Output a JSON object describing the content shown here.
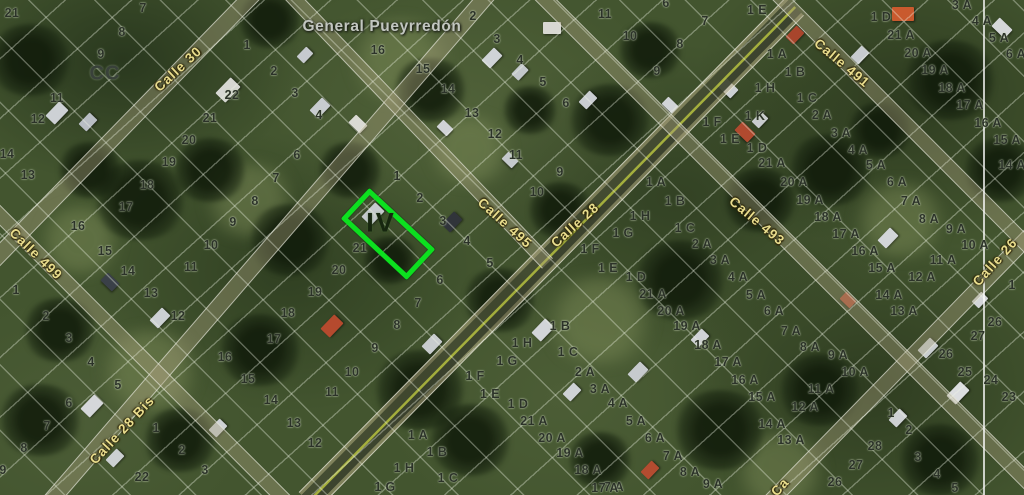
{
  "map": {
    "avenue_label": "General Pueyrredón",
    "avenue_pos": {
      "x": 382,
      "y": 27
    },
    "block_label": "CC",
    "block_label_pos": {
      "x": 105,
      "y": 74
    },
    "highlight": {
      "label": "IV",
      "x": 383,
      "y": 229,
      "w": 80,
      "h": 32,
      "rot": 43,
      "color": "#0ce01f"
    },
    "boundary_x": 983,
    "colors": {
      "parcel_text": "#2c3329",
      "street_text": "#e9dd8d",
      "avenue_text": "#c2c6c0",
      "highlight_stroke": "#0ce01f"
    },
    "streets": [
      {
        "t": "Calle 30",
        "x": 178,
        "y": 69,
        "r": -43
      },
      {
        "t": "Calle 499",
        "x": 36,
        "y": 254,
        "r": 44
      },
      {
        "t": "Calle 28 Bis",
        "x": 122,
        "y": 430,
        "r": -47
      },
      {
        "t": "Calle 495",
        "x": 505,
        "y": 223,
        "r": 42
      },
      {
        "t": "Calle 28",
        "x": 575,
        "y": 225,
        "r": -42
      },
      {
        "t": "Calle 493",
        "x": 757,
        "y": 221,
        "r": 40
      },
      {
        "t": "Calle 491",
        "x": 842,
        "y": 63,
        "r": 40
      },
      {
        "t": "Calle 26",
        "x": 995,
        "y": 262,
        "r": -48
      },
      {
        "t": "Ca",
        "x": 780,
        "y": 487,
        "r": -48
      }
    ],
    "roads": [
      {
        "name": "calle-30",
        "x1": 258,
        "y1": -12,
        "x2": -12,
        "y2": 265,
        "w": 15,
        "kind": "minor"
      },
      {
        "name": "calle-28-bis",
        "x1": 492,
        "y1": -12,
        "x2": 50,
        "y2": 500,
        "w": 15,
        "kind": "minor"
      },
      {
        "name": "calle-28",
        "x1": 795,
        "y1": 5,
        "x2": 308,
        "y2": 500,
        "w": 24,
        "kind": "major"
      },
      {
        "name": "calle-26",
        "x1": 1035,
        "y1": 228,
        "x2": 765,
        "y2": 505,
        "w": 14,
        "kind": "minor"
      },
      {
        "name": "calle-499",
        "x1": -12,
        "y1": 202,
        "x2": 288,
        "y2": 502,
        "w": 13,
        "kind": "minor"
      },
      {
        "name": "calle-495",
        "x1": 286,
        "y1": -12,
        "x2": 548,
        "y2": 262,
        "w": 13,
        "kind": "minor"
      },
      {
        "name": "calle-493",
        "x1": 540,
        "y1": -8,
        "x2": 1035,
        "y2": 487,
        "w": 14,
        "kind": "minor"
      },
      {
        "name": "calle-491",
        "x1": 776,
        "y1": -8,
        "x2": 1030,
        "y2": 247,
        "w": 13,
        "kind": "minor"
      }
    ],
    "parcels": [
      [
        "21",
        12,
        13
      ],
      [
        "7",
        143,
        8
      ],
      [
        "8",
        122,
        32
      ],
      [
        "9",
        101,
        54
      ],
      [
        "11",
        57,
        98
      ],
      [
        "12",
        38,
        119
      ],
      [
        "14",
        7,
        154
      ],
      [
        "13",
        28,
        175
      ],
      [
        "1",
        247,
        45
      ],
      [
        "2",
        274,
        71
      ],
      [
        "3",
        295,
        93
      ],
      [
        "4",
        319,
        115
      ],
      [
        "22",
        232,
        95
      ],
      [
        "21",
        210,
        118
      ],
      [
        "20",
        189,
        140
      ],
      [
        "19",
        169,
        162
      ],
      [
        "18",
        147,
        185
      ],
      [
        "17",
        126,
        207
      ],
      [
        "16",
        78,
        226
      ],
      [
        "15",
        105,
        251
      ],
      [
        "14",
        128,
        271
      ],
      [
        "13",
        151,
        293
      ],
      [
        "12",
        178,
        316
      ],
      [
        "6",
        297,
        155
      ],
      [
        "7",
        276,
        178
      ],
      [
        "8",
        255,
        201
      ],
      [
        "9",
        233,
        222
      ],
      [
        "10",
        211,
        245
      ],
      [
        "11",
        191,
        267
      ],
      [
        "1",
        16,
        290
      ],
      [
        "2",
        46,
        316
      ],
      [
        "3",
        69,
        338
      ],
      [
        "4",
        91,
        362
      ],
      [
        "5",
        118,
        385
      ],
      [
        "6",
        69,
        403
      ],
      [
        "7",
        47,
        426
      ],
      [
        "8",
        24,
        448
      ],
      [
        "9",
        3,
        470
      ],
      [
        "1",
        156,
        428
      ],
      [
        "2",
        182,
        450
      ],
      [
        "3",
        205,
        470
      ],
      [
        "22",
        142,
        477
      ],
      [
        "17",
        274,
        339
      ],
      [
        "16",
        225,
        357
      ],
      [
        "15",
        248,
        379
      ],
      [
        "14",
        271,
        400
      ],
      [
        "13",
        294,
        423
      ],
      [
        "12",
        315,
        443
      ],
      [
        "11",
        332,
        392
      ],
      [
        "10",
        352,
        372
      ],
      [
        "9",
        375,
        348
      ],
      [
        "18",
        288,
        313
      ],
      [
        "1",
        397,
        176
      ],
      [
        "2",
        420,
        198
      ],
      [
        "3",
        443,
        221
      ],
      [
        "4",
        467,
        241
      ],
      [
        "5",
        490,
        263
      ],
      [
        "6",
        440,
        280
      ],
      [
        "7",
        418,
        303
      ],
      [
        "8",
        397,
        325
      ],
      [
        "21",
        360,
        248
      ],
      [
        "20",
        339,
        270
      ],
      [
        "19",
        315,
        292
      ],
      [
        "2",
        473,
        16
      ],
      [
        "3",
        497,
        39
      ],
      [
        "4",
        520,
        60
      ],
      [
        "5",
        543,
        82
      ],
      [
        "6",
        566,
        103
      ],
      [
        "16",
        378,
        50
      ],
      [
        "15",
        423,
        69
      ],
      [
        "14",
        448,
        89
      ],
      [
        "13",
        472,
        113
      ],
      [
        "12",
        495,
        134
      ],
      [
        "11",
        516,
        155
      ],
      [
        "10",
        537,
        192
      ],
      [
        "9",
        560,
        172
      ],
      [
        "6",
        666,
        3
      ],
      [
        "7",
        705,
        21
      ],
      [
        "8",
        680,
        44
      ],
      [
        "9",
        657,
        71
      ],
      [
        "10",
        630,
        36
      ],
      [
        "11",
        605,
        14
      ],
      [
        "1 E",
        757,
        10
      ],
      [
        "1 D",
        881,
        17
      ],
      [
        "21 A",
        901,
        35
      ],
      [
        "20 A",
        918,
        53
      ],
      [
        "19 A",
        935,
        70
      ],
      [
        "18 A",
        952,
        88
      ],
      [
        "17 A",
        970,
        105
      ],
      [
        "16 A",
        988,
        123
      ],
      [
        "15 A",
        1007,
        140
      ],
      [
        "3 A",
        962,
        5
      ],
      [
        "4 A",
        982,
        21
      ],
      [
        "5 A",
        999,
        38
      ],
      [
        "6 A",
        1016,
        54
      ],
      [
        "1 A",
        777,
        54
      ],
      [
        "1 B",
        795,
        72
      ],
      [
        "1 H",
        765,
        88
      ],
      [
        "1 C",
        807,
        98
      ],
      [
        "1 K",
        755,
        116
      ],
      [
        "2 A",
        822,
        115
      ],
      [
        "1 F",
        712,
        122
      ],
      [
        "3 A",
        841,
        133
      ],
      [
        "1 E",
        730,
        139
      ],
      [
        "1 D",
        757,
        148
      ],
      [
        "4 A",
        858,
        150
      ],
      [
        "21 A",
        772,
        163
      ],
      [
        "20 A",
        794,
        182
      ],
      [
        "19 A",
        810,
        200
      ],
      [
        "18 A",
        828,
        217
      ],
      [
        "17 A",
        846,
        234
      ],
      [
        "16 A",
        865,
        251
      ],
      [
        "15 A",
        882,
        268
      ],
      [
        "14 A",
        889,
        295
      ],
      [
        "13 A",
        904,
        311
      ],
      [
        "12 A",
        922,
        277
      ],
      [
        "11 A",
        943,
        260
      ],
      [
        "10 A",
        975,
        245
      ],
      [
        "9 A",
        956,
        229
      ],
      [
        "8 A",
        929,
        219
      ],
      [
        "7 A",
        911,
        201
      ],
      [
        "6 A",
        897,
        182
      ],
      [
        "5 A",
        876,
        165
      ],
      [
        "14 A",
        1012,
        165
      ],
      [
        "1 A",
        656,
        182
      ],
      [
        "1 B",
        675,
        201
      ],
      [
        "1 H",
        640,
        216
      ],
      [
        "1 G",
        623,
        233
      ],
      [
        "1 C",
        685,
        228
      ],
      [
        "2 A",
        702,
        244
      ],
      [
        "3 A",
        720,
        260
      ],
      [
        "4 A",
        738,
        277
      ],
      [
        "5 A",
        756,
        295
      ],
      [
        "6 A",
        774,
        311
      ],
      [
        "1 F",
        590,
        249
      ],
      [
        "1 E",
        608,
        268
      ],
      [
        "1 D",
        636,
        277
      ],
      [
        "21 A",
        653,
        294
      ],
      [
        "20 A",
        671,
        311
      ],
      [
        "19 A",
        687,
        326
      ],
      [
        "18 A",
        708,
        345
      ],
      [
        "17 A",
        728,
        362
      ],
      [
        "16 A",
        745,
        380
      ],
      [
        "15 A",
        762,
        397
      ],
      [
        "14 A",
        772,
        424
      ],
      [
        "13 A",
        791,
        440
      ],
      [
        "7 A",
        791,
        331
      ],
      [
        "8 A",
        810,
        347
      ],
      [
        "9 A",
        838,
        355
      ],
      [
        "10 A",
        855,
        372
      ],
      [
        "11 A",
        821,
        389
      ],
      [
        "12 A",
        805,
        407
      ],
      [
        "5 A",
        636,
        421
      ],
      [
        "6 A",
        655,
        438
      ],
      [
        "7 A",
        673,
        456
      ],
      [
        "8 A",
        690,
        472
      ],
      [
        "9 A",
        713,
        484
      ],
      [
        "7 A",
        614,
        487
      ],
      [
        "26",
        995,
        322
      ],
      [
        "27",
        978,
        336
      ],
      [
        "26",
        946,
        354
      ],
      [
        "25",
        965,
        372
      ],
      [
        "24",
        991,
        380
      ],
      [
        "23",
        1009,
        397
      ],
      [
        "1",
        891,
        413
      ],
      [
        "2",
        909,
        430
      ],
      [
        "3",
        918,
        457
      ],
      [
        "4",
        937,
        474
      ],
      [
        "5",
        955,
        488
      ],
      [
        "28",
        875,
        446
      ],
      [
        "27",
        856,
        465
      ],
      [
        "26",
        835,
        482
      ],
      [
        "1",
        1012,
        285
      ],
      [
        "1 B",
        560,
        326
      ],
      [
        "1 H",
        522,
        343
      ],
      [
        "1 C",
        568,
        352
      ],
      [
        "1 G",
        507,
        361
      ],
      [
        "2 A",
        585,
        372
      ],
      [
        "1 F",
        475,
        376
      ],
      [
        "3 A",
        600,
        389
      ],
      [
        "1 E",
        490,
        394
      ],
      [
        "1 D",
        518,
        404
      ],
      [
        "4 A",
        618,
        403
      ],
      [
        "21 A",
        534,
        421
      ],
      [
        "20 A",
        552,
        438
      ],
      [
        "19 A",
        570,
        453
      ],
      [
        "18 A",
        588,
        470
      ],
      [
        "17 A",
        605,
        488
      ],
      [
        "1 A",
        418,
        435
      ],
      [
        "1 B",
        437,
        452
      ],
      [
        "1 H",
        404,
        468
      ],
      [
        "1 C",
        448,
        478
      ],
      [
        "1 G",
        385,
        487
      ]
    ]
  }
}
